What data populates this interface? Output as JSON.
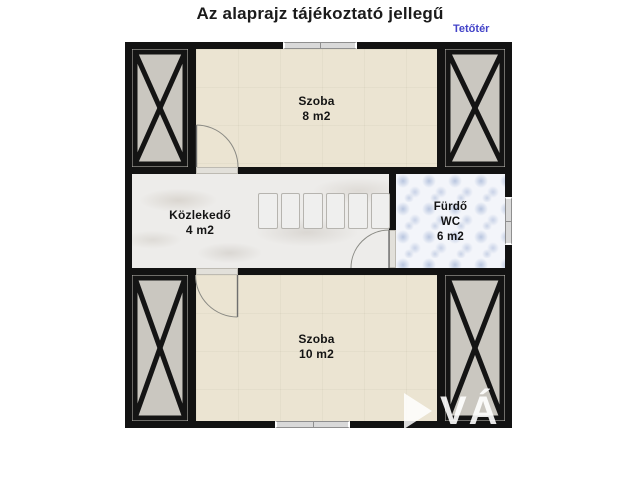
{
  "header": {
    "title": "Az alaprajz tájékoztató jellegű",
    "floor_label": "Tetőtér"
  },
  "rooms": {
    "top": {
      "name": "Szoba",
      "area": "8 m2"
    },
    "hallway": {
      "name": "Közlekedő",
      "area": "4 m2"
    },
    "bathroom": {
      "name": "Fürdő",
      "sub": "WC",
      "area": "6 m2"
    },
    "bottom": {
      "name": "Szoba",
      "area": "10 m2"
    }
  },
  "watermark": {
    "text": "VÁ"
  },
  "colors": {
    "accent_blue": "#4343c8",
    "wall_black": "#121212",
    "floor_beige": "#ebe4d2",
    "floor_marble": "#edecea",
    "floor_bath_blue": "#f3f5fa",
    "bath_pattern_blue": "#94a8d0",
    "panel_gray": "#cac7c0"
  }
}
